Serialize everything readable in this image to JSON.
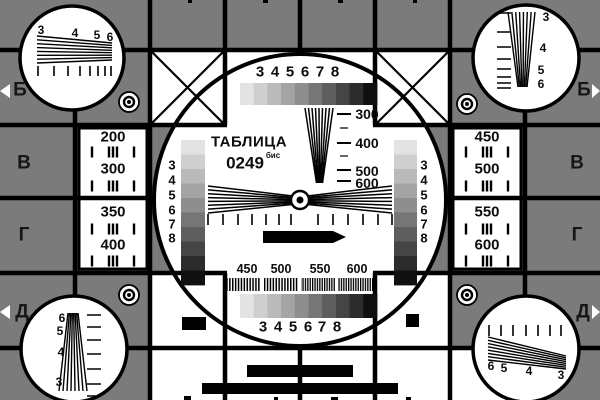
{
  "card": {
    "title": "ТАБЛИЦА",
    "code": "0249",
    "code_suffix": "бис",
    "colors": {
      "background_gray": "#7b7b7b",
      "line_black": "#000000",
      "panel_white": "#ffffff",
      "letter_dark": "#161616"
    },
    "grayscale_steps": [
      "#e3e3e3",
      "#cfcfcf",
      "#bababa",
      "#a4a4a4",
      "#8e8e8e",
      "#767676",
      "#5e5e5e",
      "#454545",
      "#2c2c2c",
      "#101010"
    ],
    "row_letters_left": [
      "Б",
      "В",
      "Г",
      "Д"
    ],
    "row_letters_right": [
      "Б",
      "В",
      "Г",
      "Д"
    ],
    "top_scale_numbers": [
      "3",
      "4",
      "5",
      "6",
      "7",
      "8"
    ],
    "bottom_scale_numbers": [
      "3",
      "4",
      "5",
      "6",
      "7",
      "8"
    ],
    "left_strip_numbers": [
      "3",
      "4",
      "5",
      "6",
      "7",
      "8"
    ],
    "right_strip_numbers": [
      "3",
      "4",
      "5",
      "6",
      "7",
      "8"
    ],
    "center_wedge_labels": [
      "300",
      "400",
      "500",
      "600"
    ],
    "bottom_freq_labels": [
      "450",
      "500",
      "550",
      "600"
    ],
    "left_panel_values": [
      "200",
      "300",
      "350",
      "400"
    ],
    "right_panel_values": [
      "450",
      "500",
      "550",
      "600"
    ],
    "panel_tick_pattern": "| ||| |",
    "corner_numbers": {
      "top_left": [
        "3",
        "4",
        "5",
        "6"
      ],
      "top_right": [
        "3",
        "4",
        "5",
        "6"
      ],
      "bottom_left": [
        "6",
        "5",
        "4",
        "3"
      ],
      "bottom_right": [
        "6",
        "5",
        "4",
        "3"
      ]
    }
  }
}
